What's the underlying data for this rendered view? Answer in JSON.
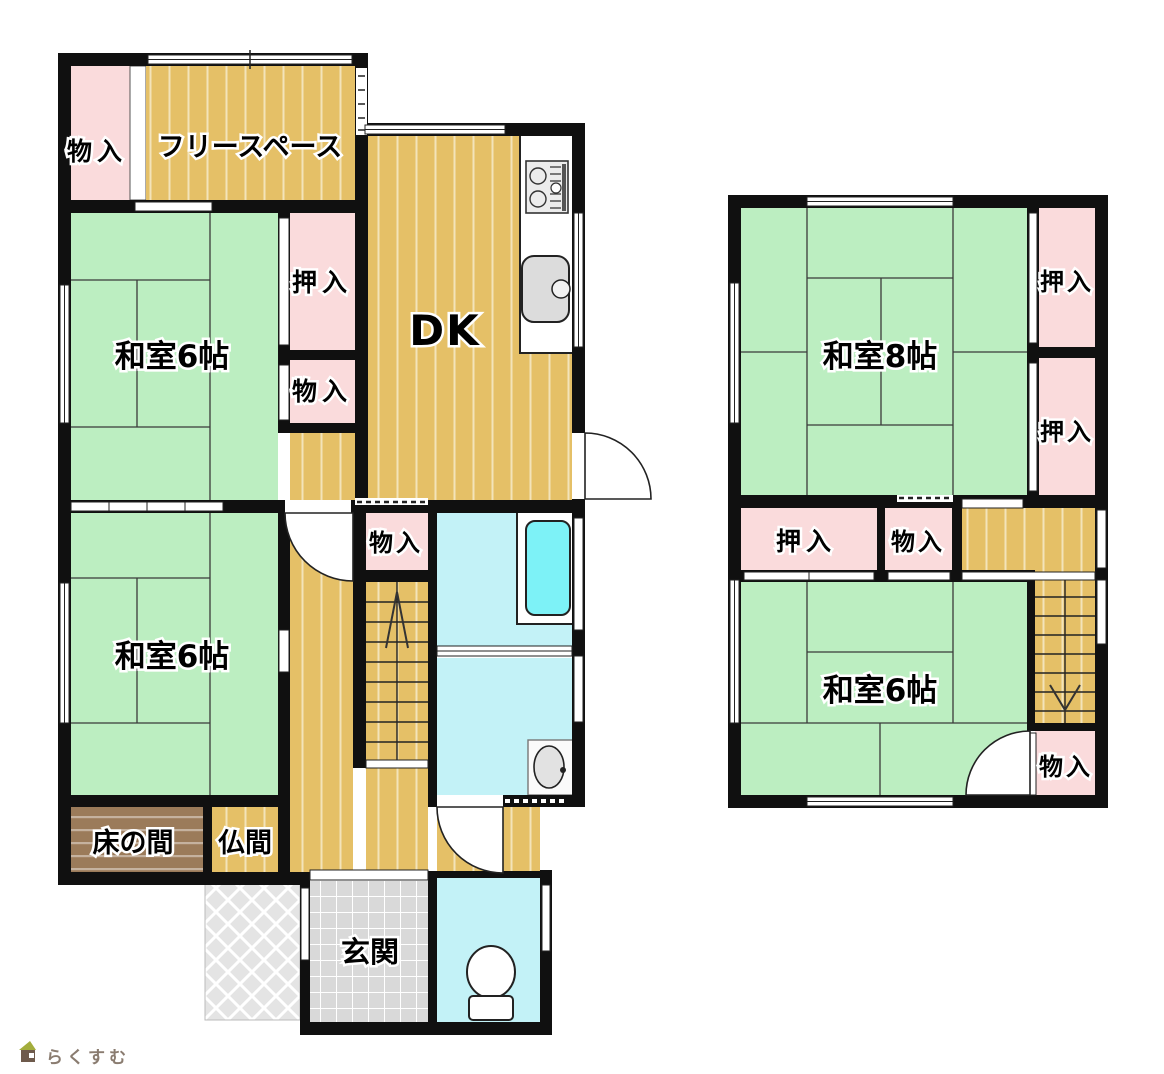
{
  "floor1": {
    "rooms": {
      "storage_tl": "物入",
      "free_space": "フリースペース",
      "washitsu_upper": "和室6帖",
      "oshiire": "押入",
      "storage_mid": "物入",
      "dk": "DK",
      "washitsu_lower": "和室6帖",
      "storage_center": "物入",
      "tokonoma": "床の間",
      "butsuma": "仏間",
      "genkan": "玄関"
    }
  },
  "floor2": {
    "rooms": {
      "washitsu8": "和室8帖",
      "oshiire_top": "押入",
      "oshiire_mid": "押入",
      "oshiire_left": "押入",
      "storage_mid": "物入",
      "washitsu6": "和室6帖",
      "storage_br": "物入"
    }
  },
  "logo": {
    "text": "らくすむ"
  },
  "colors": {
    "tatami": "#bceec1",
    "wood": "#e5c067",
    "closet": "#fadbdc",
    "wet_room": "#c3f2f7",
    "bathtub": "#7df2f7",
    "entrance_tile": "#d9d9d9",
    "porch": "#e4e4e4",
    "tokonoma": "#9b7b5a",
    "wall": "#101010"
  }
}
